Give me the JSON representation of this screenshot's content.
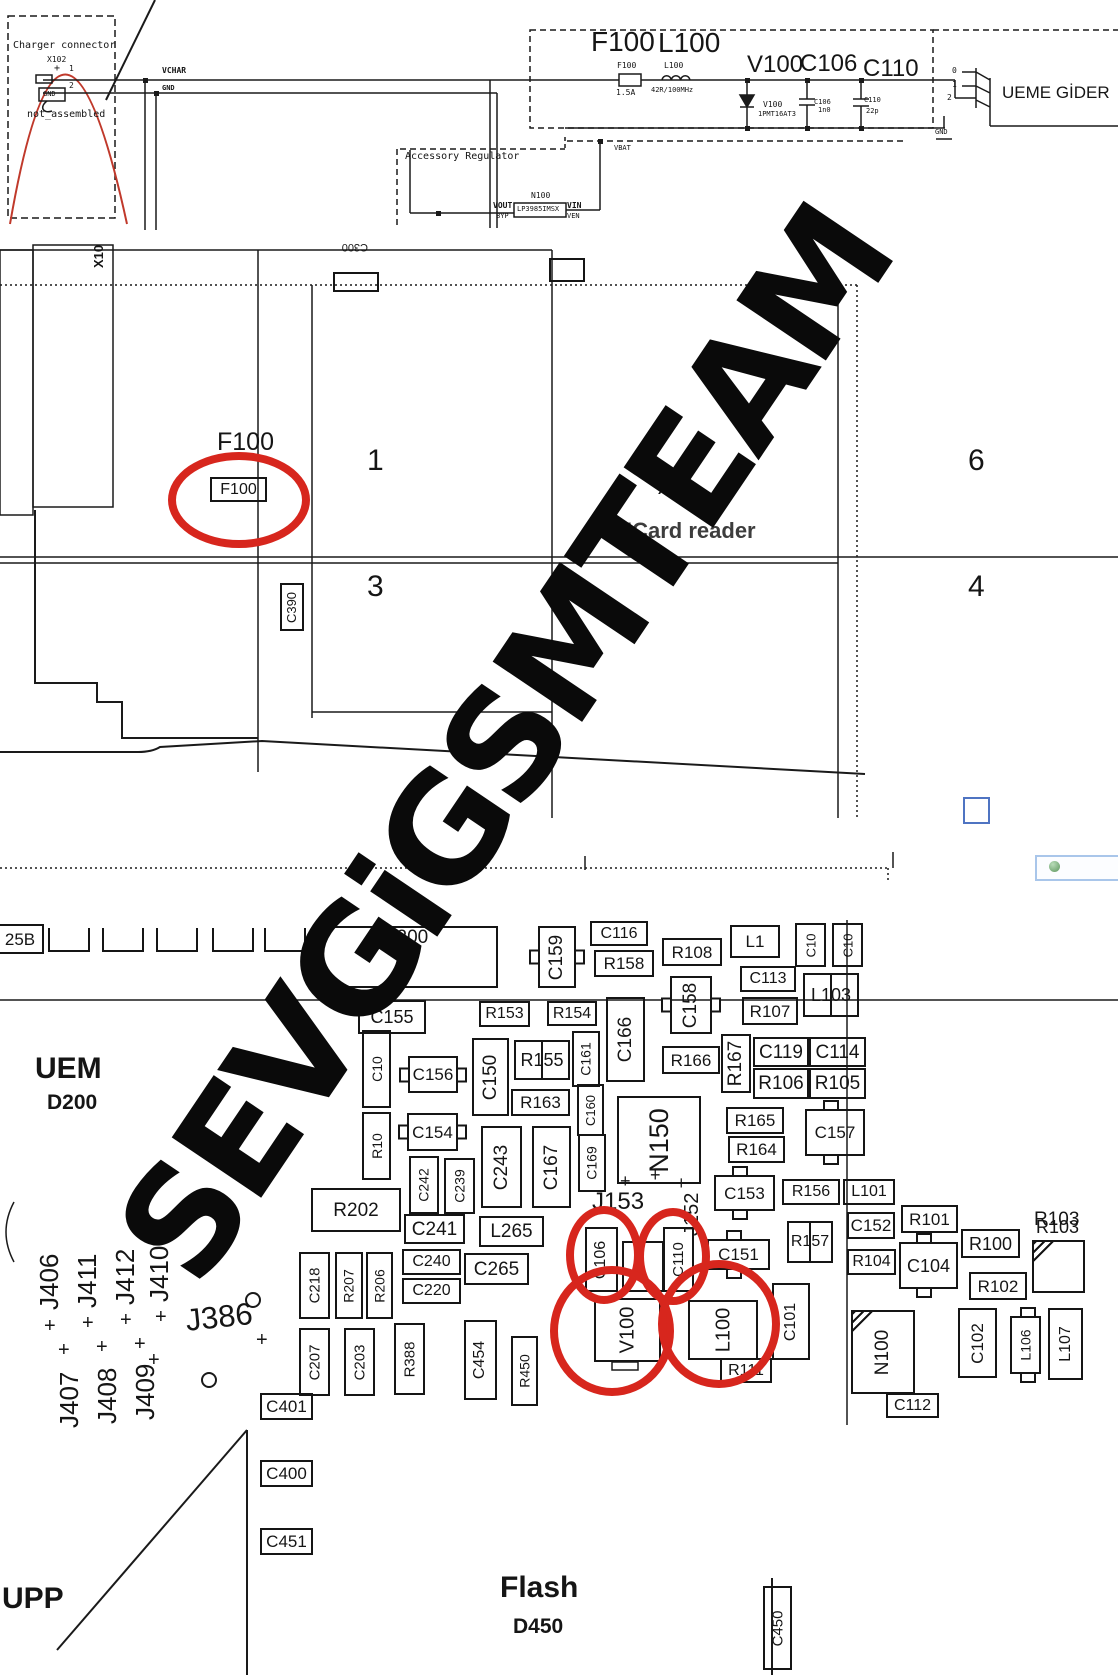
{
  "watermark": "SEVGiGSMTEAM",
  "colors": {
    "highlight": "#d7261d",
    "schematic_curve": "#c0392b",
    "window_frame": "#a9c6ea",
    "blue_marker": "#4f74c2"
  },
  "top_schematic": {
    "charger_title": "Charger connector",
    "charger_ref": "X102",
    "charger_note": "not_assembled",
    "nets": {
      "vchar": "VCHAR",
      "gnd": "GND",
      "vbat": "VBAT"
    },
    "filter_refs": [
      "F100",
      "L100",
      "V100",
      "C106",
      "C110"
    ],
    "values": {
      "F100": "1.5A",
      "L100": "42R/100MHz",
      "V100": "1PMT16AT3",
      "C106": "1n0",
      "C110": "22p"
    },
    "connector_pins": [
      "0",
      "1",
      "2"
    ],
    "destination": "UEME GİDER",
    "regulator": {
      "title": "Accessory Regulator",
      "ref": "N100",
      "part": "LP3985IMSX",
      "pins": [
        "VOUT",
        "VIN",
        "BYP",
        "VEN"
      ]
    }
  },
  "middle_layout": {
    "cells": [
      "1",
      "6",
      "3",
      "4"
    ],
    "f100_callout": "F100",
    "sim_reader": "SIMCard reader",
    "x386": "X386",
    "x100": "X10",
    "c300": "C300"
  },
  "bottom_layout": {
    "uem": "UEM",
    "uem_ref": "D200",
    "upp": "UPP",
    "flash": "Flash",
    "flash_ref": "D450",
    "pads_label": "25B"
  },
  "components": [
    {
      "l": "F100",
      "x": 210,
      "y": 477,
      "w": 57,
      "h": 25,
      "fs": 16
    },
    {
      "l": "C390",
      "x": 280,
      "y": 583,
      "w": 24,
      "h": 48,
      "o": "v",
      "fs": 13
    },
    {
      "l": "",
      "x": 333,
      "y": 272,
      "w": 46,
      "h": 20,
      "blank": 1
    },
    {
      "l": "",
      "x": 549,
      "y": 258,
      "w": 36,
      "h": 24,
      "blank": 1
    },
    {
      "l": "25B",
      "x": -2,
      "y": 924,
      "w": 46,
      "h": 30,
      "noleft": 1,
      "fs": 17
    },
    {
      "l": "R200",
      "x": 313,
      "y": 926,
      "w": 185,
      "h": 62,
      "lp": "top",
      "fs": 19
    },
    {
      "l": "C159",
      "x": 538,
      "y": 926,
      "w": 38,
      "h": 62,
      "o": "v",
      "tabs": "lr"
    },
    {
      "l": "C116",
      "x": 590,
      "y": 921,
      "w": 58,
      "h": 25
    },
    {
      "l": "R158",
      "x": 594,
      "y": 950,
      "w": 60,
      "h": 27
    },
    {
      "l": "R108",
      "x": 662,
      "y": 938,
      "w": 60,
      "h": 28
    },
    {
      "l": "L1",
      "x": 730,
      "y": 925,
      "w": 50,
      "h": 33,
      "fs": 17
    },
    {
      "l": "C10",
      "x": 795,
      "y": 923,
      "w": 31,
      "h": 44,
      "o": "v",
      "fs": 13
    },
    {
      "l": "C10",
      "x": 832,
      "y": 923,
      "w": 31,
      "h": 44,
      "o": "v",
      "fs": 13
    },
    {
      "l": "C113",
      "x": 740,
      "y": 966,
      "w": 56,
      "h": 26
    },
    {
      "l": "R107",
      "x": 742,
      "y": 997,
      "w": 56,
      "h": 28
    },
    {
      "l": "L103",
      "x": 803,
      "y": 973,
      "w": 56,
      "h": 44,
      "split": 1,
      "fs": 18
    },
    {
      "l": "C158",
      "x": 670,
      "y": 976,
      "w": 42,
      "h": 58,
      "o": "v",
      "tabs": "lr"
    },
    {
      "l": "R153",
      "x": 479,
      "y": 1001,
      "w": 51,
      "h": 26
    },
    {
      "l": "R154",
      "x": 547,
      "y": 1001,
      "w": 50,
      "h": 25
    },
    {
      "l": "C166",
      "x": 606,
      "y": 997,
      "w": 39,
      "h": 85,
      "o": "v"
    },
    {
      "l": "R166",
      "x": 662,
      "y": 1046,
      "w": 58,
      "h": 28
    },
    {
      "l": "R167",
      "x": 721,
      "y": 1034,
      "w": 30,
      "h": 59,
      "o": "v"
    },
    {
      "l": "C119",
      "x": 753,
      "y": 1037,
      "w": 56,
      "h": 30
    },
    {
      "l": "C114",
      "x": 809,
      "y": 1037,
      "w": 57,
      "h": 30
    },
    {
      "l": "R106",
      "x": 753,
      "y": 1068,
      "w": 56,
      "h": 31
    },
    {
      "l": "R105",
      "x": 809,
      "y": 1068,
      "w": 57,
      "h": 31
    },
    {
      "l": "R165",
      "x": 726,
      "y": 1107,
      "w": 58,
      "h": 27
    },
    {
      "l": "R164",
      "x": 728,
      "y": 1136,
      "w": 57,
      "h": 27
    },
    {
      "l": "C157",
      "x": 805,
      "y": 1109,
      "w": 60,
      "h": 47,
      "tabs": "tb",
      "fs": 17
    },
    {
      "l": "C155",
      "x": 358,
      "y": 1000,
      "w": 68,
      "h": 34,
      "fs": 18
    },
    {
      "l": "C10",
      "x": 362,
      "y": 1030,
      "w": 29,
      "h": 78,
      "o": "v",
      "fs": 14
    },
    {
      "l": "R10",
      "x": 362,
      "y": 1112,
      "w": 29,
      "h": 68,
      "o": "v",
      "fs": 14
    },
    {
      "l": "C156",
      "x": 408,
      "y": 1056,
      "w": 50,
      "h": 37,
      "tabs": "lr",
      "fs": 17
    },
    {
      "l": "C154",
      "x": 407,
      "y": 1113,
      "w": 51,
      "h": 38,
      "tabs": "lr",
      "fs": 17
    },
    {
      "l": "C150",
      "x": 472,
      "y": 1038,
      "w": 37,
      "h": 78,
      "o": "v"
    },
    {
      "l": "R155",
      "x": 514,
      "y": 1040,
      "w": 56,
      "h": 40,
      "split": 1,
      "fs": 18
    },
    {
      "l": "C161",
      "x": 572,
      "y": 1031,
      "w": 28,
      "h": 56,
      "o": "v",
      "fs": 14
    },
    {
      "l": "R163",
      "x": 511,
      "y": 1089,
      "w": 59,
      "h": 27
    },
    {
      "l": "C160",
      "x": 577,
      "y": 1084,
      "w": 27,
      "h": 52,
      "o": "v",
      "fs": 13
    },
    {
      "l": "C169",
      "x": 578,
      "y": 1134,
      "w": 28,
      "h": 58,
      "o": "v",
      "fs": 14
    },
    {
      "l": "C243",
      "x": 481,
      "y": 1126,
      "w": 41,
      "h": 82,
      "o": "v"
    },
    {
      "l": "C167",
      "x": 532,
      "y": 1126,
      "w": 39,
      "h": 82,
      "o": "v"
    },
    {
      "l": "C242",
      "x": 409,
      "y": 1156,
      "w": 30,
      "h": 58,
      "o": "v",
      "fs": 14
    },
    {
      "l": "C239",
      "x": 444,
      "y": 1158,
      "w": 31,
      "h": 56,
      "o": "v",
      "fs": 14
    },
    {
      "l": "C241",
      "x": 404,
      "y": 1214,
      "w": 61,
      "h": 30
    },
    {
      "l": "R202",
      "x": 311,
      "y": 1188,
      "w": 90,
      "h": 44,
      "fs": 19
    },
    {
      "l": "L265",
      "x": 479,
      "y": 1216,
      "w": 65,
      "h": 31
    },
    {
      "l": "C240",
      "x": 402,
      "y": 1249,
      "w": 59,
      "h": 26
    },
    {
      "l": "C220",
      "x": 402,
      "y": 1278,
      "w": 59,
      "h": 26
    },
    {
      "l": "C265",
      "x": 464,
      "y": 1253,
      "w": 65,
      "h": 32
    },
    {
      "l": "C218",
      "x": 299,
      "y": 1252,
      "w": 31,
      "h": 67,
      "o": "v",
      "fs": 15
    },
    {
      "l": "R207",
      "x": 335,
      "y": 1252,
      "w": 28,
      "h": 67,
      "o": "v",
      "fs": 14
    },
    {
      "l": "R206",
      "x": 366,
      "y": 1252,
      "w": 27,
      "h": 67,
      "o": "v",
      "fs": 14
    },
    {
      "l": "C207",
      "x": 299,
      "y": 1328,
      "w": 31,
      "h": 68,
      "o": "v",
      "fs": 15
    },
    {
      "l": "C203",
      "x": 344,
      "y": 1328,
      "w": 31,
      "h": 68,
      "o": "v",
      "fs": 15
    },
    {
      "l": "R388",
      "x": 394,
      "y": 1323,
      "w": 31,
      "h": 72,
      "o": "v",
      "fs": 15
    },
    {
      "l": "C454",
      "x": 464,
      "y": 1320,
      "w": 33,
      "h": 80,
      "o": "v",
      "fs": 16
    },
    {
      "l": "R450",
      "x": 511,
      "y": 1336,
      "w": 27,
      "h": 70,
      "o": "v",
      "fs": 14
    },
    {
      "l": "N150",
      "x": 617,
      "y": 1096,
      "w": 84,
      "h": 88,
      "o": "v",
      "fs": 27
    },
    {
      "l": "C153",
      "x": 714,
      "y": 1175,
      "w": 61,
      "h": 36,
      "tabs": "tb",
      "fs": 17
    },
    {
      "l": "R156",
      "x": 782,
      "y": 1179,
      "w": 58,
      "h": 26
    },
    {
      "l": "L101",
      "x": 843,
      "y": 1179,
      "w": 52,
      "h": 26
    },
    {
      "l": "C152",
      "x": 847,
      "y": 1212,
      "w": 48,
      "h": 27
    },
    {
      "l": "R101",
      "x": 901,
      "y": 1205,
      "w": 57,
      "h": 28
    },
    {
      "l": "R157",
      "x": 787,
      "y": 1221,
      "w": 46,
      "h": 42,
      "split": 1,
      "fs": 16
    },
    {
      "l": "C151",
      "x": 707,
      "y": 1239,
      "w": 63,
      "h": 31,
      "tabs": "tb",
      "fs": 17
    },
    {
      "l": "R104",
      "x": 847,
      "y": 1249,
      "w": 49,
      "h": 26
    },
    {
      "l": "C104",
      "x": 899,
      "y": 1242,
      "w": 59,
      "h": 47,
      "tabs": "tb",
      "fs": 18
    },
    {
      "l": "R100",
      "x": 961,
      "y": 1229,
      "w": 59,
      "h": 29
    },
    {
      "l": "R102",
      "x": 969,
      "y": 1272,
      "w": 58,
      "h": 28
    },
    {
      "l": "R103",
      "x": 1032,
      "y": 1240,
      "w": 53,
      "h": 53,
      "hatch": 1,
      "lp": "above",
      "fs": 18
    },
    {
      "l": "C106",
      "x": 585,
      "y": 1227,
      "w": 33,
      "h": 65,
      "o": "v",
      "fs": 16
    },
    {
      "l": "",
      "x": 622,
      "y": 1241,
      "w": 42,
      "h": 51,
      "blank": 1
    },
    {
      "l": "C110",
      "x": 663,
      "y": 1227,
      "w": 31,
      "h": 65,
      "o": "v",
      "fs": 15
    },
    {
      "l": "V100",
      "x": 594,
      "y": 1298,
      "w": 67,
      "h": 64,
      "o": "v",
      "fs": 20
    },
    {
      "l": "L100",
      "x": 688,
      "y": 1300,
      "w": 70,
      "h": 60,
      "o": "v",
      "fs": 20
    },
    {
      "l": "C101",
      "x": 772,
      "y": 1283,
      "w": 38,
      "h": 77,
      "o": "v",
      "fs": 16
    },
    {
      "l": "R111",
      "x": 720,
      "y": 1358,
      "w": 52,
      "h": 25
    },
    {
      "l": "N100",
      "x": 851,
      "y": 1310,
      "w": 64,
      "h": 84,
      "o": "v",
      "hatch": 1,
      "fs": 19
    },
    {
      "l": "C102",
      "x": 958,
      "y": 1308,
      "w": 39,
      "h": 70,
      "o": "v",
      "fs": 17
    },
    {
      "l": "L106",
      "x": 1010,
      "y": 1316,
      "w": 31,
      "h": 58,
      "o": "v",
      "tabs": "tb",
      "fs": 14
    },
    {
      "l": "L107",
      "x": 1048,
      "y": 1308,
      "w": 35,
      "h": 72,
      "o": "v",
      "fs": 16
    },
    {
      "l": "C112",
      "x": 886,
      "y": 1393,
      "w": 53,
      "h": 25
    },
    {
      "l": "C450",
      "x": 763,
      "y": 1586,
      "w": 29,
      "h": 84,
      "o": "v",
      "fs": 15
    },
    {
      "l": "C401",
      "x": 260,
      "y": 1393,
      "w": 53,
      "h": 27
    },
    {
      "l": "C400",
      "x": 260,
      "y": 1460,
      "w": 53,
      "h": 27
    },
    {
      "l": "C451",
      "x": 260,
      "y": 1528,
      "w": 53,
      "h": 27
    }
  ],
  "pads": [
    {
      "x": 48,
      "y": 928,
      "w": 42,
      "h": 24
    },
    {
      "x": 102,
      "y": 928,
      "w": 42,
      "h": 24
    },
    {
      "x": 156,
      "y": 928,
      "w": 42,
      "h": 24
    },
    {
      "x": 212,
      "y": 928,
      "w": 42,
      "h": 24
    },
    {
      "x": 264,
      "y": 928,
      "w": 42,
      "h": 24
    }
  ],
  "texts": [
    {
      "t": "Charger connector",
      "x": 13,
      "y": 41,
      "s": 10,
      "mono": 1
    },
    {
      "t": "X102",
      "x": 47,
      "y": 56,
      "s": 8,
      "mono": 1
    },
    {
      "t": "+",
      "x": 54,
      "y": 64,
      "s": 10,
      "mono": 1
    },
    {
      "t": "1",
      "x": 69,
      "y": 65,
      "s": 8,
      "mono": 1
    },
    {
      "t": "2",
      "x": 69,
      "y": 82,
      "s": 8,
      "mono": 1
    },
    {
      "t": "GND",
      "x": 43,
      "y": 91,
      "s": 7,
      "mono": 1
    },
    {
      "t": "not_assembled",
      "x": 27,
      "y": 110,
      "s": 10,
      "mono": 1
    },
    {
      "t": "VCHAR",
      "x": 162,
      "y": 67,
      "s": 8,
      "mono": 1,
      "b": 1
    },
    {
      "t": "GND",
      "x": 162,
      "y": 85,
      "s": 7,
      "mono": 1,
      "b": 1
    },
    {
      "t": "F100",
      "x": 591,
      "y": 28,
      "s": 28
    },
    {
      "t": "L100",
      "x": 658,
      "y": 29,
      "s": 28
    },
    {
      "t": "V100",
      "x": 747,
      "y": 53,
      "s": 24
    },
    {
      "t": "C106",
      "x": 800,
      "y": 52,
      "s": 24
    },
    {
      "t": "C110",
      "x": 863,
      "y": 57,
      "s": 24
    },
    {
      "t": "F100",
      "x": 617,
      "y": 62,
      "s": 8,
      "mono": 1
    },
    {
      "t": "1.5A",
      "x": 616,
      "y": 89,
      "s": 8,
      "mono": 1
    },
    {
      "t": "L100",
      "x": 664,
      "y": 62,
      "s": 8,
      "mono": 1
    },
    {
      "t": "42R/100MHz",
      "x": 651,
      "y": 87,
      "s": 7,
      "mono": 1
    },
    {
      "t": "V100",
      "x": 763,
      "y": 101,
      "s": 8,
      "mono": 1
    },
    {
      "t": "1PMT16AT3",
      "x": 758,
      "y": 111,
      "s": 7,
      "mono": 1
    },
    {
      "t": "C106",
      "x": 814,
      "y": 99,
      "s": 7,
      "mono": 1
    },
    {
      "t": "1n0",
      "x": 818,
      "y": 107,
      "s": 7,
      "mono": 1
    },
    {
      "t": "C110",
      "x": 864,
      "y": 97,
      "s": 7,
      "mono": 1
    },
    {
      "t": "22p",
      "x": 866,
      "y": 108,
      "s": 7,
      "mono": 1
    },
    {
      "t": "0",
      "x": 952,
      "y": 67,
      "s": 8,
      "mono": 1
    },
    {
      "t": "1",
      "x": 952,
      "y": 81,
      "s": 8,
      "mono": 1
    },
    {
      "t": "2",
      "x": 947,
      "y": 94,
      "s": 8,
      "mono": 1
    },
    {
      "t": "UEME GİDER",
      "x": 1002,
      "y": 84,
      "s": 17
    },
    {
      "t": "GND",
      "x": 935,
      "y": 129,
      "s": 7,
      "mono": 1
    },
    {
      "t": "VBAT",
      "x": 614,
      "y": 145,
      "s": 7,
      "mono": 1
    },
    {
      "t": "Accessory Regulator",
      "x": 405,
      "y": 152,
      "s": 10,
      "mono": 1
    },
    {
      "t": "N100",
      "x": 531,
      "y": 192,
      "s": 8,
      "mono": 1
    },
    {
      "t": "VOUT",
      "x": 493,
      "y": 202,
      "s": 8,
      "mono": 1,
      "b": 1
    },
    {
      "t": "VIN",
      "x": 567,
      "y": 202,
      "s": 8,
      "mono": 1,
      "b": 1
    },
    {
      "t": "BYP",
      "x": 496,
      "y": 213,
      "s": 7,
      "mono": 1
    },
    {
      "t": "VEN",
      "x": 567,
      "y": 213,
      "s": 7,
      "mono": 1
    },
    {
      "t": "LP3985IMSX",
      "x": 517,
      "y": 206,
      "s": 7,
      "mono": 1
    },
    {
      "t": "X10",
      "x": 92,
      "y": 268,
      "s": 13,
      "r": -90,
      "b": 1
    },
    {
      "t": "C300",
      "x": 368,
      "y": 252,
      "s": 11,
      "r": 180
    },
    {
      "t": "F100",
      "x": 217,
      "y": 430,
      "s": 25
    },
    {
      "t": "1",
      "x": 367,
      "y": 446,
      "s": 30
    },
    {
      "t": "6",
      "x": 968,
      "y": 446,
      "s": 30
    },
    {
      "t": "3",
      "x": 367,
      "y": 572,
      "s": 30
    },
    {
      "t": "4",
      "x": 968,
      "y": 572,
      "s": 30
    },
    {
      "t": "X386",
      "x": 658,
      "y": 483,
      "s": 13,
      "b": 1
    },
    {
      "t": "SIMCard reader",
      "x": 593,
      "y": 520,
      "s": 22,
      "b": 1,
      "c": "#3d3d3d"
    },
    {
      "t": "UEM",
      "x": 35,
      "y": 1054,
      "s": 30,
      "b": 1
    },
    {
      "t": "D200",
      "x": 47,
      "y": 1092,
      "s": 21,
      "b": 1
    },
    {
      "t": "J153",
      "x": 592,
      "y": 1190,
      "s": 24
    },
    {
      "t": "J152",
      "x": 682,
      "y": 1236,
      "s": 20,
      "r": -90
    },
    {
      "t": "+",
      "x": 620,
      "y": 1172,
      "s": 18
    },
    {
      "t": "+",
      "x": 650,
      "y": 1166,
      "s": 18
    },
    {
      "t": "+",
      "x": 676,
      "y": 1174,
      "s": 18
    },
    {
      "t": "J406",
      "x": 36,
      "y": 1310,
      "s": 26,
      "r": -90
    },
    {
      "t": "J411",
      "x": 74,
      "y": 1308,
      "s": 26,
      "r": -90
    },
    {
      "t": "J412",
      "x": 112,
      "y": 1305,
      "s": 26,
      "r": -90
    },
    {
      "t": "J410",
      "x": 146,
      "y": 1302,
      "s": 26,
      "r": -90
    },
    {
      "t": "J386",
      "x": 184,
      "y": 1305,
      "s": 31,
      "r": -6
    },
    {
      "t": "J407",
      "x": 56,
      "y": 1428,
      "s": 26,
      "r": -90
    },
    {
      "t": "J408",
      "x": 94,
      "y": 1424,
      "s": 26,
      "r": -90
    },
    {
      "t": "J409",
      "x": 132,
      "y": 1420,
      "s": 26,
      "r": -90
    },
    {
      "t": "+",
      "x": 44,
      "y": 1316,
      "s": 20
    },
    {
      "t": "+",
      "x": 82,
      "y": 1313,
      "s": 20
    },
    {
      "t": "+",
      "x": 120,
      "y": 1310,
      "s": 20
    },
    {
      "t": "+",
      "x": 155,
      "y": 1307,
      "s": 20
    },
    {
      "t": "+",
      "x": 58,
      "y": 1340,
      "s": 20
    },
    {
      "t": "+",
      "x": 96,
      "y": 1337,
      "s": 20
    },
    {
      "t": "+",
      "x": 134,
      "y": 1334,
      "s": 20
    },
    {
      "t": "+",
      "x": 256,
      "y": 1330,
      "s": 20
    },
    {
      "t": "+",
      "x": 148,
      "y": 1350,
      "s": 20
    },
    {
      "t": "UPP",
      "x": 2,
      "y": 1584,
      "s": 30,
      "b": 1
    },
    {
      "t": "Flash",
      "x": 500,
      "y": 1573,
      "s": 30,
      "b": 1
    },
    {
      "t": "D450",
      "x": 513,
      "y": 1616,
      "s": 21,
      "b": 1
    },
    {
      "t": "R103",
      "x": 1034,
      "y": 1210,
      "s": 19
    }
  ],
  "ellipses": [
    {
      "x": 168,
      "y": 452,
      "w": 142,
      "h": 96
    },
    {
      "x": 566,
      "y": 1206,
      "w": 76,
      "h": 98
    },
    {
      "x": 636,
      "y": 1208,
      "w": 74,
      "h": 97
    },
    {
      "x": 550,
      "y": 1266,
      "w": 124,
      "h": 130
    },
    {
      "x": 658,
      "y": 1260,
      "w": 122,
      "h": 128
    }
  ]
}
